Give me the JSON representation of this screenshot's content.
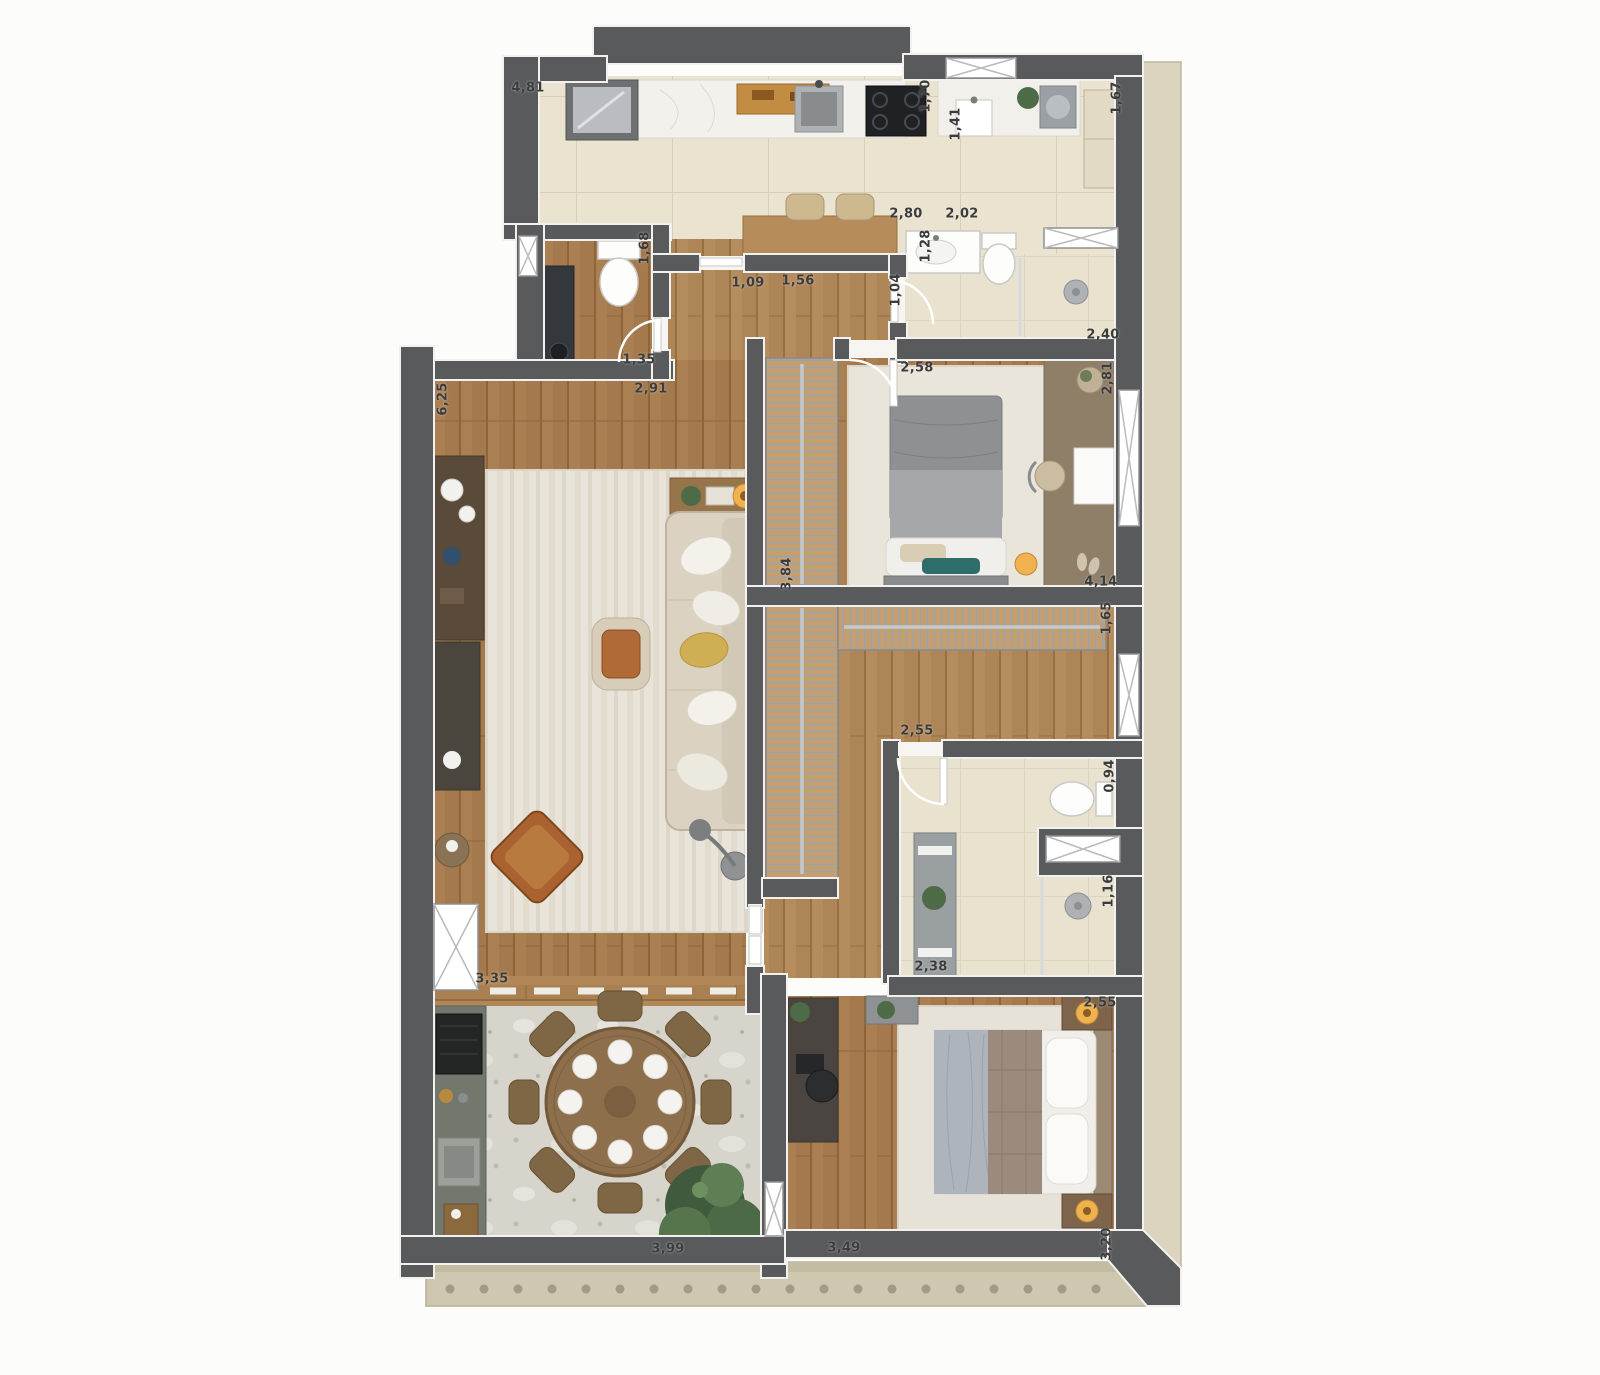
{
  "title": "apartment-floor-plan",
  "dimensions_unit": "m",
  "palette": {
    "wall": "#595a5c",
    "fixture": "#fdfdfc",
    "band": "#dbd4bf",
    "ledge": "#cfc8b0",
    "lamp": "#f0b24f",
    "plant": "#4e6b47",
    "sofa": "#dbd2c1",
    "labelColor": "#3c3c3c",
    "wood": "#aa8052",
    "wood_light": "#b58c5e",
    "tile": "#eae3cf",
    "terrazzo": "#d7d4cc",
    "rug": "#e9e4d9",
    "closet_wood": "#c49e6e"
  },
  "dimension_labels": [
    {
      "text": "4,81",
      "x": 528,
      "y": 88,
      "rot": 0
    },
    {
      "text": "1,70",
      "x": 926,
      "y": 96,
      "rot": -90
    },
    {
      "text": "1,41",
      "x": 956,
      "y": 124,
      "rot": -90
    },
    {
      "text": "1,67",
      "x": 1117,
      "y": 98,
      "rot": -90
    },
    {
      "text": "2,80",
      "x": 906,
      "y": 214,
      "rot": 0
    },
    {
      "text": "2,02",
      "x": 962,
      "y": 214,
      "rot": 0
    },
    {
      "text": "1,28",
      "x": 926,
      "y": 246,
      "rot": -90
    },
    {
      "text": "1,68",
      "x": 645,
      "y": 248,
      "rot": -90
    },
    {
      "text": "1,09",
      "x": 748,
      "y": 283,
      "rot": 0
    },
    {
      "text": "1,56",
      "x": 798,
      "y": 281,
      "rot": 0
    },
    {
      "text": "1,04",
      "x": 896,
      "y": 290,
      "rot": -90
    },
    {
      "text": "2,40",
      "x": 1103,
      "y": 335,
      "rot": 0
    },
    {
      "text": "1,35",
      "x": 639,
      "y": 360,
      "rot": 0
    },
    {
      "text": "2,91",
      "x": 651,
      "y": 389,
      "rot": 0
    },
    {
      "text": "6,25",
      "x": 443,
      "y": 399,
      "rot": -90
    },
    {
      "text": "2,58",
      "x": 917,
      "y": 368,
      "rot": 0
    },
    {
      "text": "2,81",
      "x": 1108,
      "y": 378,
      "rot": -90
    },
    {
      "text": "3,84",
      "x": 787,
      "y": 574,
      "rot": -90
    },
    {
      "text": "4,14",
      "x": 1101,
      "y": 582,
      "rot": 0
    },
    {
      "text": "1,65",
      "x": 1107,
      "y": 618,
      "rot": -90
    },
    {
      "text": "2,55",
      "x": 917,
      "y": 731,
      "rot": 0
    },
    {
      "text": "0,94",
      "x": 1110,
      "y": 776,
      "rot": -90
    },
    {
      "text": "1,16",
      "x": 1109,
      "y": 891,
      "rot": -90
    },
    {
      "text": "3,35",
      "x": 492,
      "y": 979,
      "rot": 0
    },
    {
      "text": "2,38",
      "x": 931,
      "y": 967,
      "rot": 0
    },
    {
      "text": "2,55",
      "x": 1100,
      "y": 1003,
      "rot": 0
    },
    {
      "text": "3,99",
      "x": 668,
      "y": 1249,
      "rot": 0
    },
    {
      "text": "3,49",
      "x": 844,
      "y": 1248,
      "rot": 0
    },
    {
      "text": "3,20",
      "x": 1107,
      "y": 1244,
      "rot": -90
    }
  ]
}
